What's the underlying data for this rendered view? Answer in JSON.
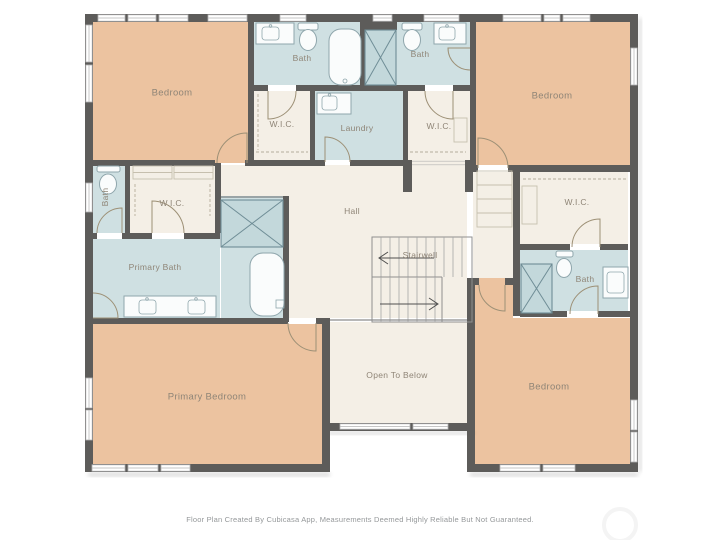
{
  "palette": {
    "wall": "#5d5c5a",
    "bedroom": "#ecc3a0",
    "bath": "#cfe0e2",
    "shower": "#c3d8db",
    "hall": "#f4efe6",
    "fixture": "#8fa6ac",
    "label": "#8f8577"
  },
  "rooms": [
    {
      "id": "bedroom-top-left",
      "label": "Bedroom"
    },
    {
      "id": "bath-top-left",
      "label": "Bath"
    },
    {
      "id": "bath-top-right",
      "label": "Bath"
    },
    {
      "id": "bedroom-top-right",
      "label": "Bedroom"
    },
    {
      "id": "wic-top-left",
      "label": "W.I.C."
    },
    {
      "id": "laundry",
      "label": "Laundry"
    },
    {
      "id": "wic-top-right",
      "label": "W.I.C."
    },
    {
      "id": "bath-left",
      "label": "Bath"
    },
    {
      "id": "wic-mid-left",
      "label": "W.I.C."
    },
    {
      "id": "hall",
      "label": "Hall"
    },
    {
      "id": "wic-right",
      "label": "W.I.C."
    },
    {
      "id": "primary-bath",
      "label": "Primary Bath"
    },
    {
      "id": "stairwell",
      "label": "Stairwell"
    },
    {
      "id": "bath-right",
      "label": "Bath"
    },
    {
      "id": "open-to-below",
      "label": "Open To Below"
    },
    {
      "id": "primary-bedroom",
      "label": "Primary Bedroom"
    },
    {
      "id": "bedroom-bottom-right",
      "label": "Bedroom"
    }
  ],
  "icons": {
    "watermark": "circular-logo"
  },
  "footer": {
    "caption": "Floor Plan Created By Cubicasa App, Measurements Deemed Highly Reliable But Not Guaranteed."
  }
}
